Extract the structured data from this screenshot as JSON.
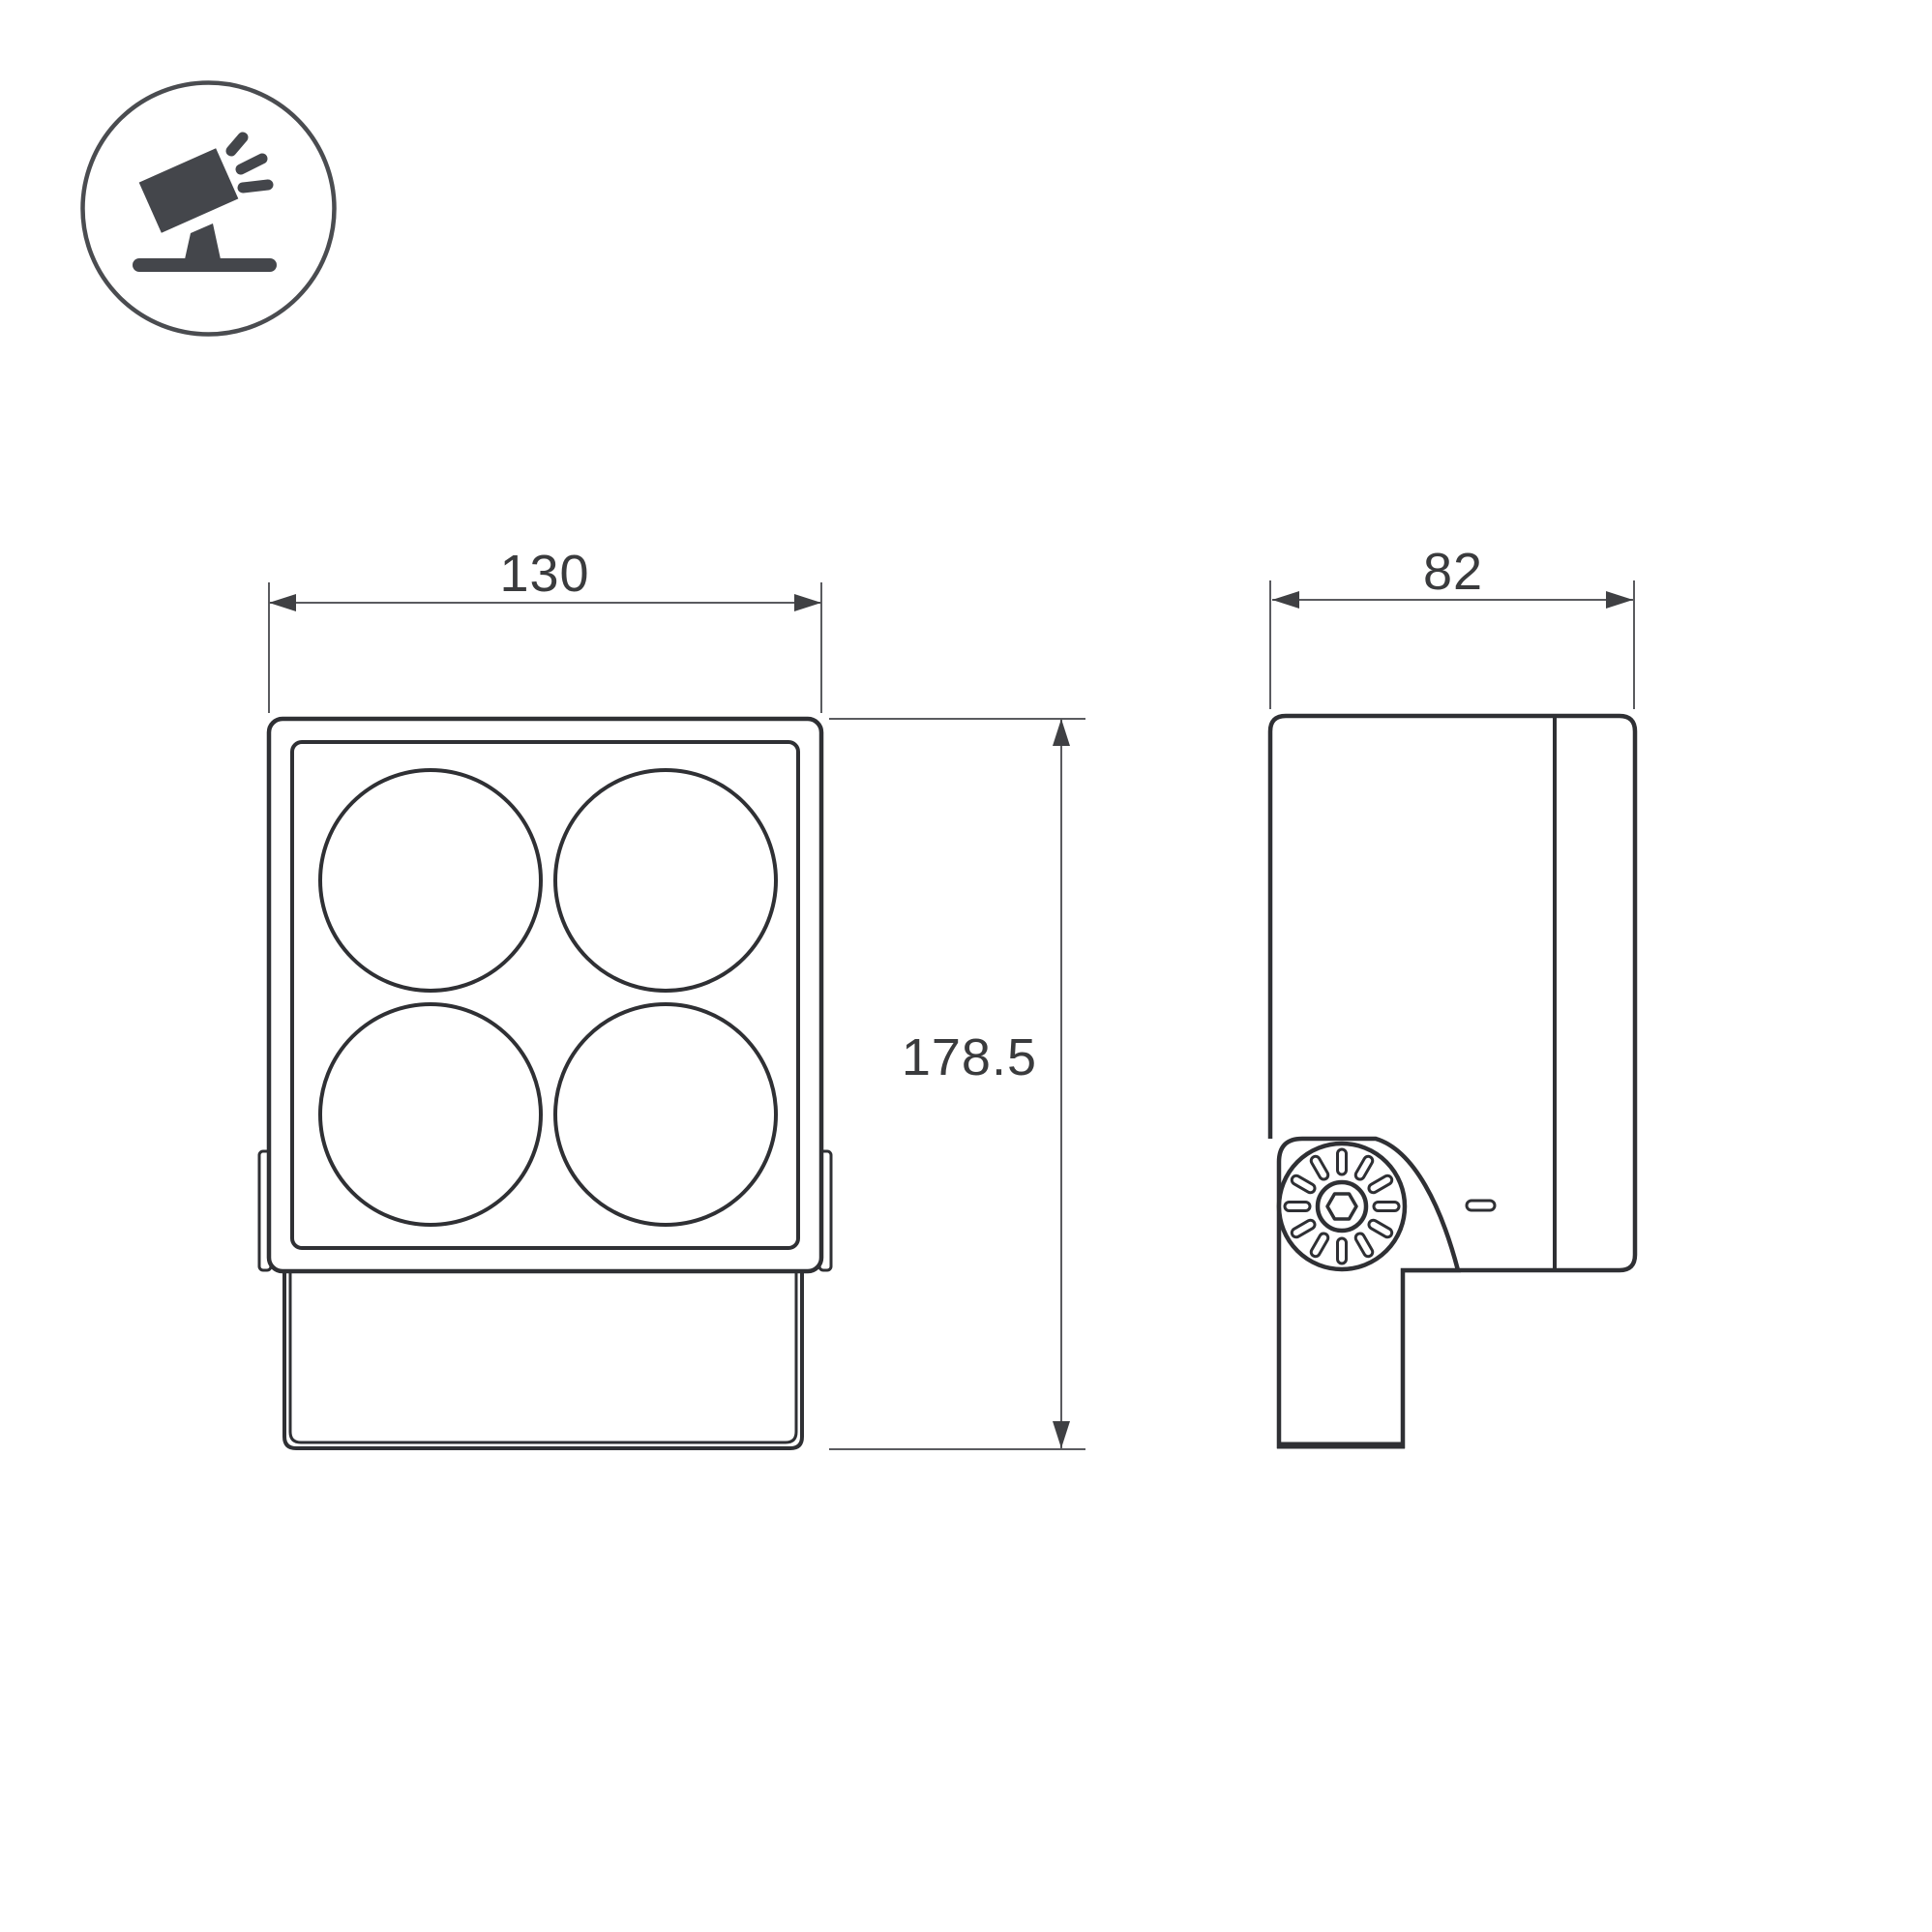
{
  "drawing": {
    "type": "technical-dimension-drawing",
    "views": {
      "front": "floodlight-front-view",
      "side": "floodlight-side-view"
    },
    "dimensions": {
      "front_width": "130",
      "side_depth": "82",
      "height": "178.5"
    }
  },
  "icon": {
    "name": "tilted-floodlight-on-stand",
    "shapes": [
      "circle-outline",
      "tilted-head",
      "stand",
      "base-bar",
      "light-rays"
    ]
  },
  "colors": {
    "background": "#ffffff",
    "object_line": "#2f3034",
    "dimension_line": "#5a5b5f",
    "arrow_fill": "#3f4043",
    "label_text": "#3a3b3d",
    "icon_fill": "#44464b"
  }
}
